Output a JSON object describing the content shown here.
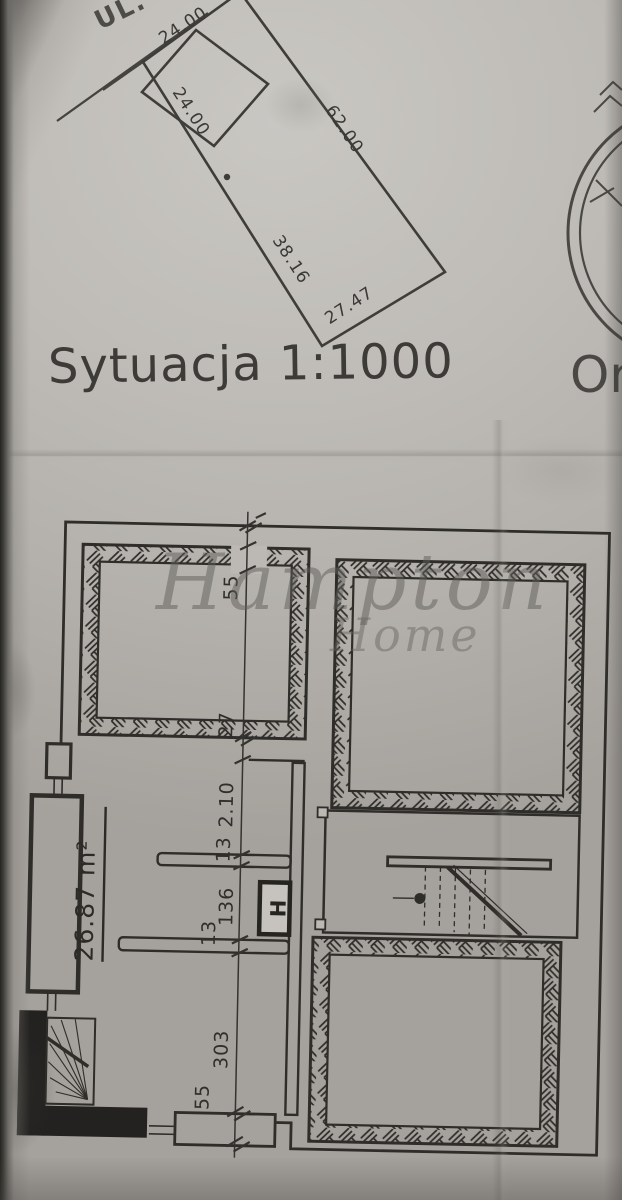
{
  "site_plan": {
    "street_label": "UL.",
    "title": "Sytuacja 1:1000",
    "orientation_label": "Or",
    "parcel_dims": {
      "top": "24.00",
      "left_upper": "24.00",
      "right": "62.00",
      "left_lower": "38.16",
      "bottom": "27.47"
    }
  },
  "floor_plan": {
    "room_area": "26.87 m²",
    "fixture_label": "H",
    "dim_chain": [
      "55",
      "27",
      "2.10",
      "13",
      "136",
      "13",
      "303",
      "55"
    ]
  },
  "watermark": {
    "primary": "Hampton",
    "secondary": "Home"
  },
  "colors": {
    "ink": "#33312c",
    "paper": "#bfbcb7",
    "watermark": "#6e6c68"
  }
}
